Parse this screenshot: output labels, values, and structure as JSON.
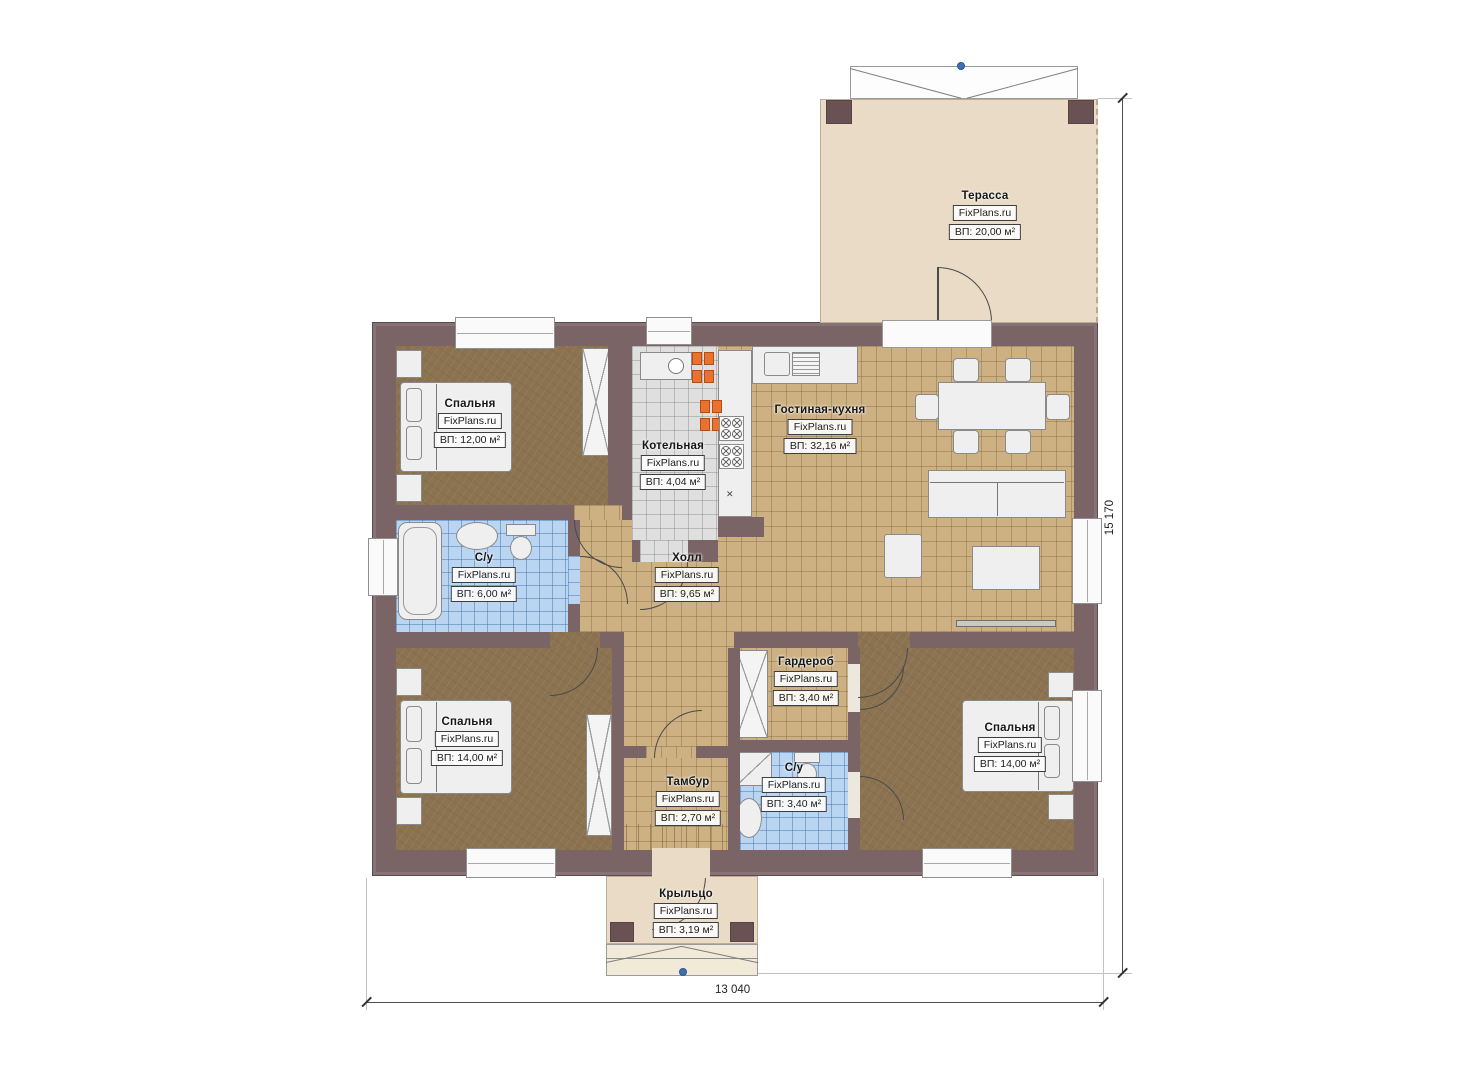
{
  "brand": "FixPlans.ru",
  "dimensions": {
    "width": "13 040",
    "height": "15 170"
  },
  "palette": {
    "wall": "#7a6466",
    "wall_dark": "#6a5254",
    "floor_living": "#cdb183",
    "floor_bedroom": "#8b7351",
    "floor_bathroom": "#b9d5f1",
    "floor_boiler": "#dfdfdf",
    "floor_terrace": "#e9dbc5",
    "radiator": "#ea7130",
    "survey_dot": "#3e6fae"
  },
  "rooms": [
    {
      "id": "terrace",
      "name": "Терасса",
      "area": "ВП: 20,00 м²"
    },
    {
      "id": "bedroom-top-left",
      "name": "Спальня",
      "area": "ВП: 12,00 м²"
    },
    {
      "id": "boiler",
      "name": "Котельная",
      "area": "ВП: 4,04 м²"
    },
    {
      "id": "living-kitchen",
      "name": "Гостиная-кухня",
      "area": "ВП: 32,16 м²"
    },
    {
      "id": "bathroom-main",
      "name": "С/у",
      "area": "ВП: 6,00 м²"
    },
    {
      "id": "hall",
      "name": "Холл",
      "area": "ВП: 9,65 м²"
    },
    {
      "id": "bedroom-bottom-left",
      "name": "Спальня",
      "area": "ВП: 14,00 м²"
    },
    {
      "id": "wardrobe",
      "name": "Гардероб",
      "area": "ВП: 3,40 м²"
    },
    {
      "id": "tambour",
      "name": "Тамбур",
      "area": "ВП: 2,70 м²"
    },
    {
      "id": "bathroom-small",
      "name": "С/у",
      "area": "ВП: 3,40 м²"
    },
    {
      "id": "bedroom-right",
      "name": "Спальня",
      "area": "ВП: 14,00 м²"
    },
    {
      "id": "porch",
      "name": "Крыльцо",
      "area": "ВП: 3,19 м²"
    }
  ]
}
